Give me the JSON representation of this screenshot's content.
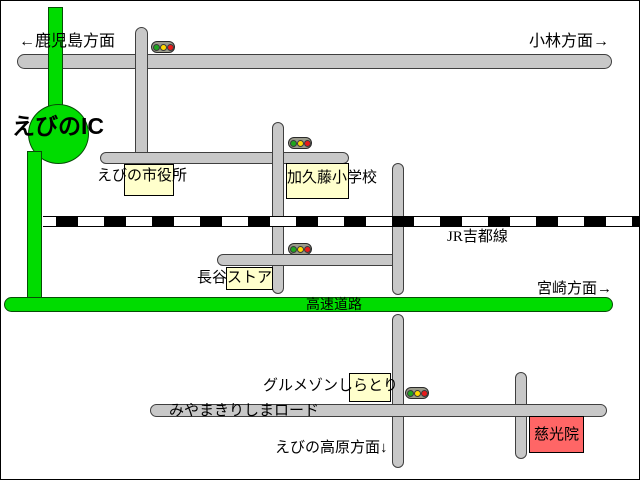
{
  "map": {
    "directions": {
      "kagoshima": "←鹿児島方面",
      "kobayashi": "小林方面→",
      "miyazaki": "宮崎方面→",
      "ebino_kogen": "えびの高原方面↓"
    },
    "landmarks": {
      "ebino_ic": "えびのIC",
      "city_hall": "えびの市役所",
      "kakuto_school": "加久藤小学校",
      "hase_store": "長谷ストア",
      "gourmet_shiratori": "グルメゾンしらとり",
      "jikouin": "慈光院"
    },
    "routes": {
      "jr_line": "JR吉都線",
      "highway": "高速道路",
      "miyama_road": "みやまきりしまロード"
    },
    "colors": {
      "road_gray": "#c8c8c8",
      "highway_green": "#00dc00",
      "landmark_yellow": "#ffffcc",
      "landmark_red": "#ff6666",
      "signal_green": "#1fa51f",
      "signal_yellow": "#ffd800",
      "signal_red": "#e81b1b"
    },
    "signals_count": 4
  }
}
